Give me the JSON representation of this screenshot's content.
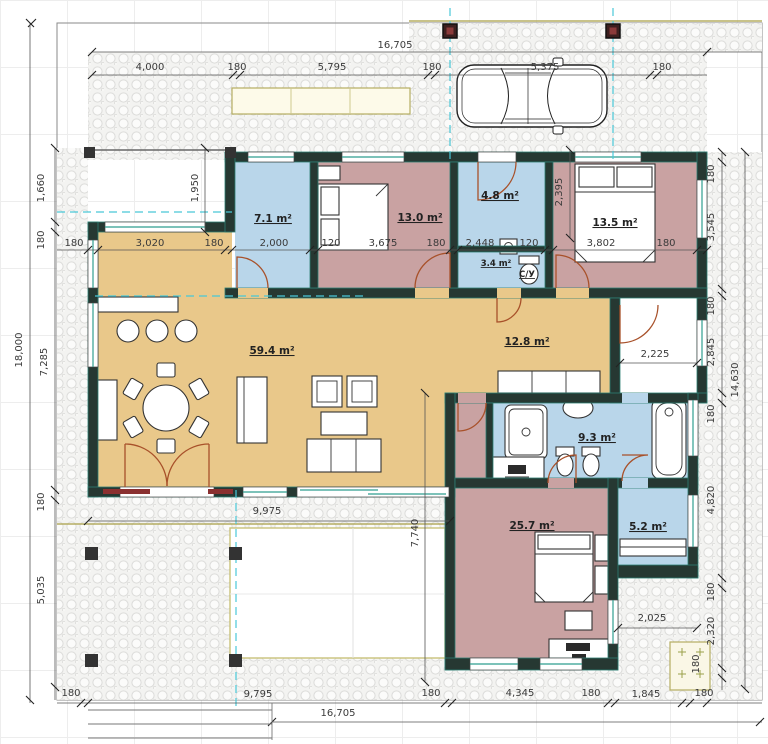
{
  "drawing": {
    "type": "architectural-floor-plan"
  },
  "colors": {
    "room_blue": "#b9d6ea",
    "room_rose": "#c9a2a2",
    "room_tan": "#e9c88a",
    "wall": "#263832",
    "teal_accent": "#2f9e8f",
    "cyan_guide": "#49c8d8",
    "door_arc": "#a8512a",
    "olive_edge": "#b5ad62",
    "dim_text": "#3a3a3a"
  },
  "rooms": {
    "wardrobe": "7.1 m²",
    "bedroom1": "13.0 m²",
    "entry": "4.8 m²",
    "wc": "3.4 m²",
    "wc_tag": "С/У",
    "bedroom2": "13.5 m²",
    "living": "59.4 m²",
    "hall": "12.8 m²",
    "bath": "9.3 m²",
    "bedroom3": "25.7 m²",
    "closet": "5.2 m²"
  },
  "dims": {
    "t1": "16,705",
    "t2": "4,000",
    "t3": "180",
    "t4": "5,795",
    "t5": "180",
    "t6": "5,375",
    "t7": "180",
    "m1": "180",
    "m2": "3,020",
    "m3": "180",
    "m4": "2,000",
    "m5": "120",
    "m6": "3,675",
    "m7": "180",
    "m8": "2,448",
    "m9": "120",
    "m10": "3,802",
    "m11": "180",
    "l1": "1,660",
    "l2": "180",
    "l3": "18,000",
    "l4": "7,285",
    "l5": "1,950",
    "l6": "180",
    "l7": "5,035",
    "r1": "180",
    "r2": "3,545",
    "r3": "180",
    "r4": "2,845",
    "r5": "180",
    "r6": "14,630",
    "r7": "4,820",
    "r8": "180",
    "r9": "2,320",
    "r10": "180",
    "i1": "2,395",
    "i2": "2,225",
    "i3": "9,975",
    "i4": "7,740",
    "i5": "2,025",
    "b1": "180",
    "b2": "9,795",
    "b3": "16,705",
    "b4": "180",
    "b5": "4,345",
    "b6": "180",
    "b7": "1,845",
    "b8": "180"
  }
}
